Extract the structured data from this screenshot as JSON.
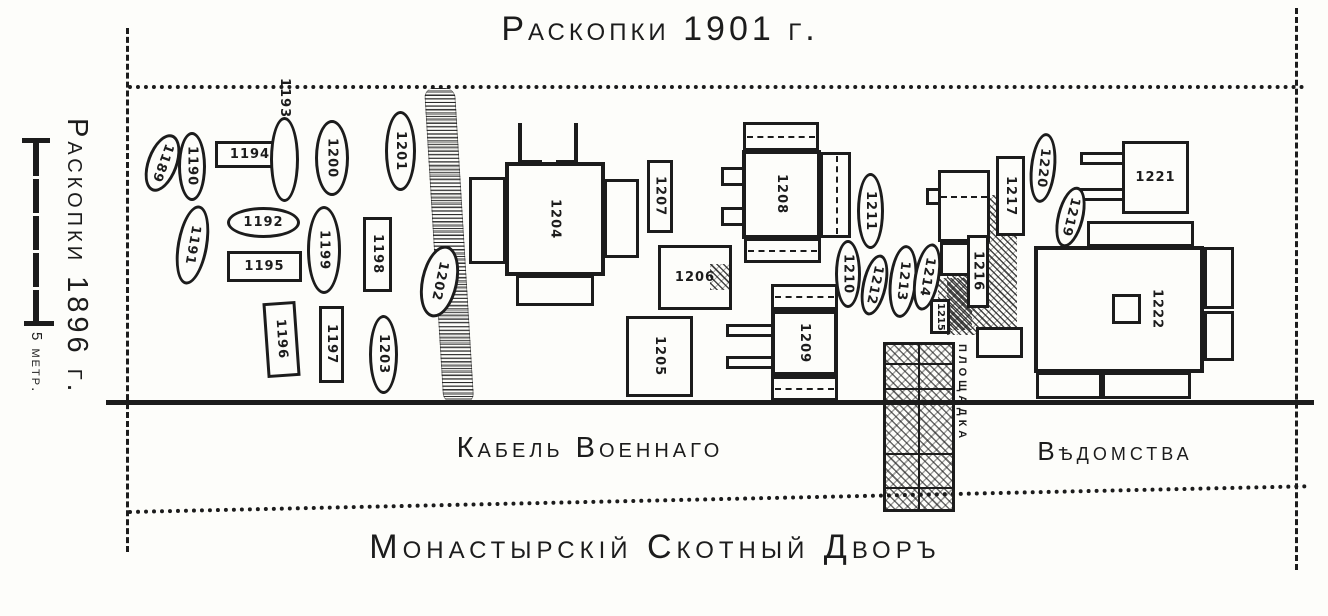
{
  "colors": {
    "ink": "#1c1c1c",
    "paper": "#fdfdfa"
  },
  "title": "Раскопки 1901 г.",
  "left_panel": {
    "excavation_label": "Раскопки 1896 г.",
    "scale_length_label": "5 метр."
  },
  "labels": {
    "cable_line1": "Кабель Военнаго",
    "cable_line2": "Вѣдомства",
    "yard": "Монастырскій Скотный Дворъ",
    "platform": "ПЛОЩАДКА"
  },
  "features": [
    {
      "id": "",
      "s": "group",
      "parts": [
        {
          "cls": "hatch",
          "x": 947,
          "y": 195,
          "w": 70,
          "h": 140
        },
        {
          "cls": "solid",
          "x": 938,
          "y": 170,
          "w": 52,
          "h": 72
        },
        {
          "cls": "dash-h",
          "x": 941,
          "y": 196,
          "w": 46,
          "h": 0
        },
        {
          "cls": "staple-l",
          "x": 926,
          "y": 188,
          "w": 13,
          "h": 17
        },
        {
          "cls": "solid",
          "x": 940,
          "y": 242,
          "w": 30,
          "h": 34
        },
        {
          "cls": "hatch",
          "x": 938,
          "y": 278,
          "w": 34,
          "h": 52
        },
        {
          "cls": "solid",
          "x": 976,
          "y": 327,
          "w": 47,
          "h": 31
        }
      ]
    },
    {
      "id": "1204",
      "s": "bld",
      "x": 505,
      "y": 162,
      "w": 100,
      "h": 114,
      "parts": [
        {
          "cls": "solid",
          "x": 469,
          "y": 177,
          "w": 37,
          "h": 87
        },
        {
          "cls": "solid",
          "x": 604,
          "y": 179,
          "w": 35,
          "h": 79
        },
        {
          "cls": "solid",
          "x": 516,
          "y": 275,
          "w": 78,
          "h": 31
        },
        {
          "cls": "corner-l",
          "x": 518,
          "y": 123,
          "w": 24,
          "h": 41
        },
        {
          "cls": "corner-r",
          "x": 556,
          "y": 123,
          "w": 22,
          "h": 41
        }
      ]
    },
    {
      "id": "1208",
      "s": "bld",
      "x": 742,
      "y": 150,
      "w": 79,
      "h": 89,
      "parts": [
        {
          "cls": "solid",
          "x": 743,
          "y": 122,
          "w": 76,
          "h": 29
        },
        {
          "cls": "dash-h",
          "x": 747,
          "y": 136,
          "w": 68,
          "h": 0
        },
        {
          "cls": "solid",
          "x": 820,
          "y": 152,
          "w": 31,
          "h": 86
        },
        {
          "cls": "dash-v",
          "x": 836,
          "y": 156,
          "w": 0,
          "h": 78
        },
        {
          "cls": "solid",
          "x": 744,
          "y": 238,
          "w": 77,
          "h": 25
        },
        {
          "cls": "dash-h",
          "x": 748,
          "y": 250,
          "w": 69,
          "h": 0
        },
        {
          "cls": "staple-l",
          "x": 721,
          "y": 167,
          "w": 22,
          "h": 19
        },
        {
          "cls": "staple-l",
          "x": 721,
          "y": 207,
          "w": 22,
          "h": 19
        }
      ]
    },
    {
      "id": "1209",
      "s": "bld",
      "x": 771,
      "y": 310,
      "w": 67,
      "h": 66,
      "parts": [
        {
          "cls": "solid",
          "x": 771,
          "y": 284,
          "w": 67,
          "h": 26
        },
        {
          "cls": "dash-h",
          "x": 775,
          "y": 296,
          "w": 59,
          "h": 0
        },
        {
          "cls": "solid",
          "x": 771,
          "y": 376,
          "w": 67,
          "h": 25
        },
        {
          "cls": "dash-h",
          "x": 775,
          "y": 388,
          "w": 59,
          "h": 0
        },
        {
          "cls": "staple-l",
          "x": 726,
          "y": 324,
          "w": 46,
          "h": 13
        },
        {
          "cls": "staple-l",
          "x": 726,
          "y": 356,
          "w": 46,
          "h": 13
        }
      ]
    },
    {
      "id": "1222",
      "s": "bld",
      "x": 1034,
      "y": 246,
      "w": 170,
      "h": 127,
      "lx": 38,
      "parts": [
        {
          "cls": "solid",
          "x": 1087,
          "y": 221,
          "w": 107,
          "h": 26
        },
        {
          "cls": "solid",
          "x": 1204,
          "y": 247,
          "w": 30,
          "h": 62
        },
        {
          "cls": "solid",
          "x": 1204,
          "y": 311,
          "w": 30,
          "h": 50
        },
        {
          "cls": "solid",
          "x": 1036,
          "y": 372,
          "w": 66,
          "h": 27
        },
        {
          "cls": "solid",
          "x": 1102,
          "y": 372,
          "w": 89,
          "h": 27
        },
        {
          "cls": "sq",
          "x": 1112,
          "y": 294,
          "w": 29,
          "h": 30,
          "layer": "over"
        }
      ]
    },
    {
      "id": "1205",
      "s": "rect",
      "x": 626,
      "y": 316,
      "w": 67,
      "h": 81,
      "parts": [
        {
          "cls": "line-v",
          "x": 641,
          "y": 318,
          "w": 0,
          "h": 77
        },
        {
          "cls": "line-v",
          "x": 677,
          "y": 318,
          "w": 0,
          "h": 77
        }
      ]
    },
    {
      "id": "1206",
      "s": "rect",
      "x": 658,
      "y": 245,
      "w": 74,
      "h": 65,
      "o": "h",
      "parts": [
        {
          "cls": "line-h",
          "x": 660,
          "y": 262,
          "w": 70,
          "h": 0
        },
        {
          "cls": "line-h",
          "x": 660,
          "y": 291,
          "w": 70,
          "h": 0
        },
        {
          "cls": "hatch",
          "x": 710,
          "y": 264,
          "w": 20,
          "h": 26,
          "layer": "over"
        }
      ]
    },
    {
      "id": "1221",
      "s": "rect",
      "x": 1122,
      "y": 141,
      "w": 67,
      "h": 73,
      "o": "h",
      "parts": [
        {
          "cls": "line-h",
          "x": 1124,
          "y": 163,
          "w": 63,
          "h": 0
        },
        {
          "cls": "line-h",
          "x": 1124,
          "y": 191,
          "w": 63,
          "h": 0
        },
        {
          "cls": "staple-l",
          "x": 1080,
          "y": 152,
          "w": 43,
          "h": 13
        },
        {
          "cls": "staple-l",
          "x": 1080,
          "y": 188,
          "w": 43,
          "h": 13
        }
      ]
    },
    {
      "id": "1194",
      "s": "rect",
      "x": 215,
      "y": 141,
      "w": 70,
      "h": 27,
      "o": "h",
      "parts": [
        {
          "cls": "dash-v",
          "x": 272,
          "y": 145,
          "w": 0,
          "h": 19
        }
      ]
    },
    {
      "id": "1195",
      "s": "rect",
      "x": 227,
      "y": 251,
      "w": 75,
      "h": 31,
      "o": "h"
    },
    {
      "id": "1196",
      "s": "rect",
      "x": 265,
      "y": 302,
      "w": 33,
      "h": 75,
      "r": -4
    },
    {
      "id": "1197",
      "s": "rect",
      "x": 319,
      "y": 306,
      "w": 25,
      "h": 77
    },
    {
      "id": "1198",
      "s": "rect",
      "x": 363,
      "y": 217,
      "w": 29,
      "h": 75
    },
    {
      "id": "1207",
      "s": "rect",
      "x": 647,
      "y": 160,
      "w": 26,
      "h": 73
    },
    {
      "id": "1215",
      "s": "rect",
      "x": 930,
      "y": 299,
      "w": 20,
      "h": 35,
      "small": true
    },
    {
      "id": "1216",
      "s": "rect",
      "x": 967,
      "y": 235,
      "w": 22,
      "h": 73
    },
    {
      "id": "1217",
      "s": "rect",
      "x": 996,
      "y": 156,
      "w": 29,
      "h": 80,
      "parts": [
        {
          "cls": "dash-v",
          "x": 1010,
          "y": 162,
          "w": 0,
          "h": 68
        }
      ]
    },
    {
      "id": "1189",
      "s": "oval",
      "x": 147,
      "y": 133,
      "w": 31,
      "h": 60,
      "r": 20
    },
    {
      "id": "1190",
      "s": "oval",
      "x": 178,
      "y": 132,
      "w": 28,
      "h": 69
    },
    {
      "id": "1191",
      "s": "oval",
      "x": 177,
      "y": 205,
      "w": 31,
      "h": 80,
      "r": 10
    },
    {
      "id": "1192",
      "s": "oval",
      "x": 227,
      "y": 207,
      "w": 73,
      "h": 31,
      "o": "h"
    },
    {
      "id": "1193",
      "s": "oval",
      "x": 270,
      "y": 117,
      "w": 29,
      "h": 85,
      "o": "above"
    },
    {
      "id": "1199",
      "s": "oval",
      "x": 307,
      "y": 206,
      "w": 34,
      "h": 88
    },
    {
      "id": "1200",
      "s": "oval",
      "x": 315,
      "y": 120,
      "w": 34,
      "h": 76
    },
    {
      "id": "1201",
      "s": "oval",
      "x": 385,
      "y": 111,
      "w": 31,
      "h": 80
    },
    {
      "id": "1202",
      "s": "oval",
      "x": 421,
      "y": 245,
      "w": 37,
      "h": 73,
      "r": 12
    },
    {
      "id": "1203",
      "s": "oval",
      "x": 369,
      "y": 315,
      "w": 29,
      "h": 79
    },
    {
      "id": "1210",
      "s": "oval",
      "x": 835,
      "y": 240,
      "w": 26,
      "h": 68
    },
    {
      "id": "1211",
      "s": "oval",
      "x": 857,
      "y": 173,
      "w": 27,
      "h": 76
    },
    {
      "id": "1212",
      "s": "oval",
      "x": 862,
      "y": 254,
      "w": 25,
      "h": 62,
      "r": 12
    },
    {
      "id": "1213",
      "s": "oval",
      "x": 889,
      "y": 245,
      "w": 28,
      "h": 73,
      "r": 6
    },
    {
      "id": "1214",
      "s": "oval",
      "x": 914,
      "y": 243,
      "w": 26,
      "h": 68,
      "r": 10
    },
    {
      "id": "1219",
      "s": "oval",
      "x": 1057,
      "y": 186,
      "w": 27,
      "h": 62,
      "r": 14
    },
    {
      "id": "1220",
      "s": "oval",
      "x": 1030,
      "y": 133,
      "w": 26,
      "h": 70,
      "r": 6
    }
  ]
}
